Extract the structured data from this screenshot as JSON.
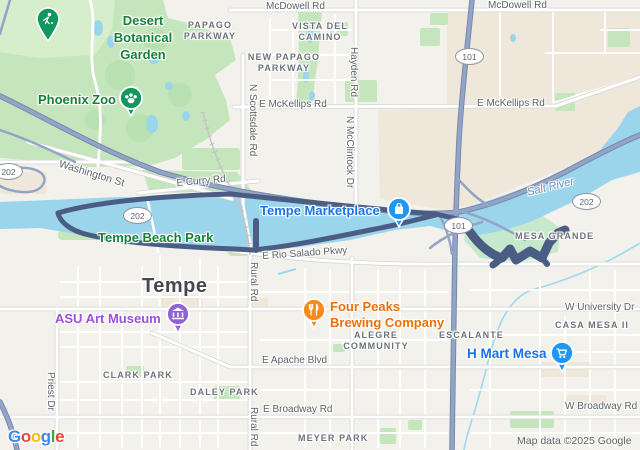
{
  "labels": {
    "mcdowell_rd_1": "McDowell Rd",
    "mcdowell_rd_2": "McDowell Rd",
    "papago_parkway_l1": "PAPAGO",
    "papago_parkway_l2": "PARKWAY",
    "vista_del_camino_l1": "VISTA DEL",
    "vista_del_camino_l2": "CAMINO",
    "new_papago_l1": "NEW PAPAGO",
    "new_papago_l2": "PARKWAY",
    "desert_botanical_l1": "Desert",
    "desert_botanical_l2": "Botanical",
    "desert_botanical_l3": "Garden",
    "phoenix_zoo": "Phoenix Zoo",
    "mckellips_1": "E McKellips Rd",
    "mckellips_2": "E McKellips Rd",
    "scottsdale_rd": "N Scottsdale Rd",
    "hayden_rd": "Hayden Rd",
    "mcclintock_dr": "N McClintock Dr",
    "washington_st": "Washington St",
    "curry_rd": "E Curry Rd",
    "salt_river": "Salt River",
    "tempe_marketplace": "Tempe Marketplace",
    "mesa_grande": "MESA GRANDE",
    "tempe_beach_park": "Tempe Beach Park",
    "rio_salado": "E Rio Salado Pkwy",
    "rural_rd_1": "Rural Rd",
    "rural_rd_2": "Rural Rd",
    "tempe_city": "Tempe",
    "priest_dr": "Priest Dr",
    "asu_art_museum": "ASU Art Museum",
    "four_peaks_l1": "Four Peaks",
    "four_peaks_l2": "Brewing Company",
    "alegre_l1": "ALEGRE",
    "alegre_l2": "COMMUNITY",
    "escalante": "ESCALANTE",
    "h_mart_mesa": "H Mart Mesa",
    "university_dr": "W University Dr",
    "casa_mesa": "CASA MESA II",
    "apache_blvd": "E Apache Blvd",
    "clark_park": "CLARK PARK",
    "daley_park": "DALEY PARK",
    "broadway_rd_e": "E Broadway Rd",
    "broadway_rd_w": "W Broadway Rd",
    "meyer_park": "MEYER PARK"
  },
  "shields": {
    "route_202": "202",
    "route_101": "101"
  },
  "icons": {
    "golf_pin": "golfer-icon",
    "zoo_pin": "paw-icon",
    "marketplace_pin": "shopping-bag-icon",
    "four_peaks_pin": "restaurant-icon",
    "asu_pin": "museum-icon",
    "hmart_pin": "shopping-cart-icon"
  },
  "colors": {
    "park_fill": "#c5e6bc",
    "water_fill": "#9bd5ec",
    "freeway": "#93a5c6",
    "route_overlay": "#4b5c85",
    "commercial_fill": "#efe8da",
    "poi_blue": "#1a73e8",
    "poi_orange": "#e8710a",
    "poi_purple": "#9c4fe0",
    "poi_green": "#188038",
    "pin_green": "#12975f",
    "pin_blue": "#2097f3",
    "pin_orange": "#f98a1e",
    "pin_purple": "#8f62d8",
    "logo_letter_colors": [
      "#4285F4",
      "#EA4335",
      "#FBBC05",
      "#4285F4",
      "#34A853",
      "#EA4335"
    ]
  },
  "logo": {
    "letters": [
      {
        "ch": "G"
      },
      {
        "ch": "o"
      },
      {
        "ch": "o"
      },
      {
        "ch": "g"
      },
      {
        "ch": "l"
      },
      {
        "ch": "e"
      }
    ]
  },
  "attribution": {
    "text": "Map data ©2025 Google"
  }
}
